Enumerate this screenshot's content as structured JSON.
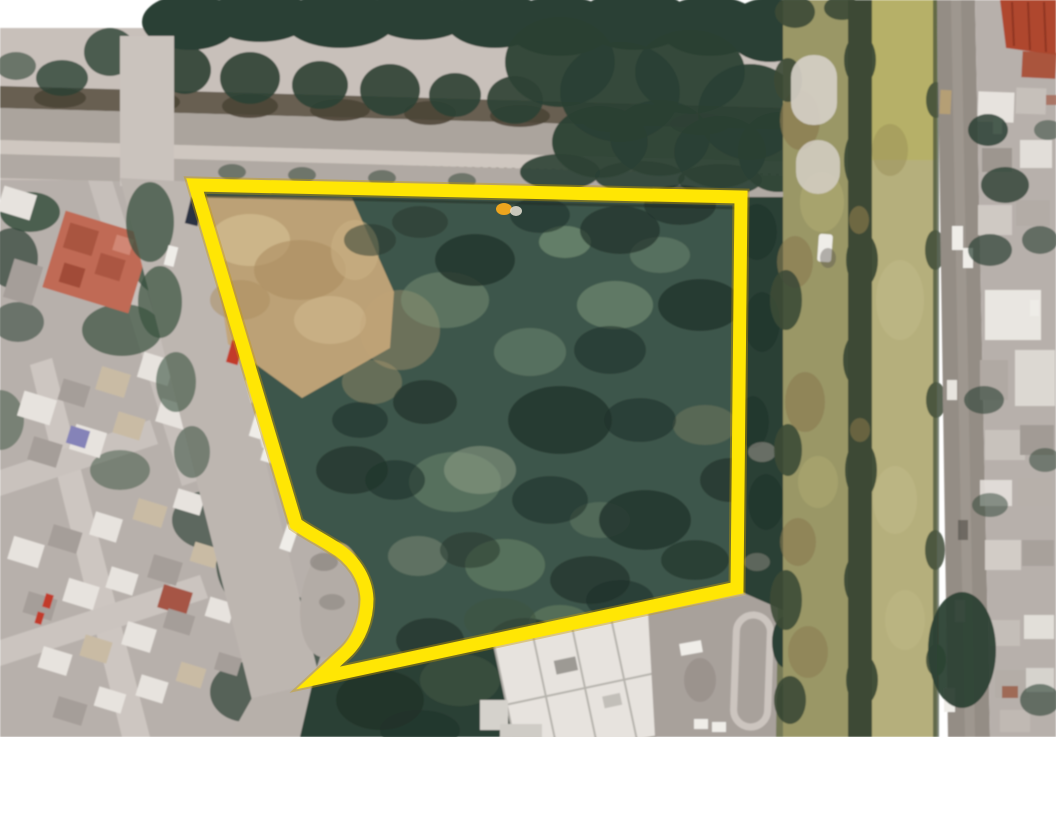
{
  "meta": {
    "type": "satellite-aerial-photo",
    "subject": "vacant land parcel outlined in yellow between a residential neighborhood and a drainage canal",
    "visible_text": "none"
  },
  "canvas": {
    "width": 1056,
    "height": 816,
    "photo_bottom": 737
  },
  "colors": {
    "page-bg": "#ffffff",
    "boundary-yellow": "#ffe604",
    "boundary-fringe": "#c79b00",
    "marker-orange": "#eda51e",
    "marker-white": "#dbd8cc",
    "parcel-green": "#3e564b",
    "parcel-dark": "#22332b",
    "parcel-light": "#7e967b",
    "dirt-tan": "#c2a478",
    "road-gray": "#aba49d",
    "sidewalk-gray": "#c8c0ba",
    "median-dark": "#5c5346",
    "urban-base": "#b7b0ab",
    "building-white": "#e7e3de",
    "building-gray": "#a59e99",
    "building-tan": "#c9bba4",
    "red-roof-left": "#c06a55",
    "red-roof-right": "#af462e",
    "purple-roof": "#8583b8",
    "canal-left": "#9a9766",
    "canal-right": "#b5af7c",
    "canal-trees": "#3c4a36",
    "tree-dark": "#2c4134",
    "tree-mid": "#39513f",
    "car-red": "#c23b2b",
    "car-navy": "#2a3142",
    "car-white": "#efede8"
  },
  "parcel": {
    "boundary_path": "M195,185 L741,197 L737,588 L318,678 L344,654 C360,640 367,618 367,599 C366,577 352,557 332,546 C321,539 309,533 296,524 Z",
    "boundary_width": 13,
    "fringe_width": 17,
    "marker": {
      "x": 504,
      "y": 209,
      "white_x": 516,
      "white_y": 211
    }
  },
  "regions": [
    "tree-lined-boulevard",
    "residential-neighborhood",
    "access-street",
    "vacant-parcel",
    "bare-dirt-area",
    "drainage-canal",
    "service-road",
    "east-neighborhood",
    "white-building",
    "parking-lot"
  ]
}
